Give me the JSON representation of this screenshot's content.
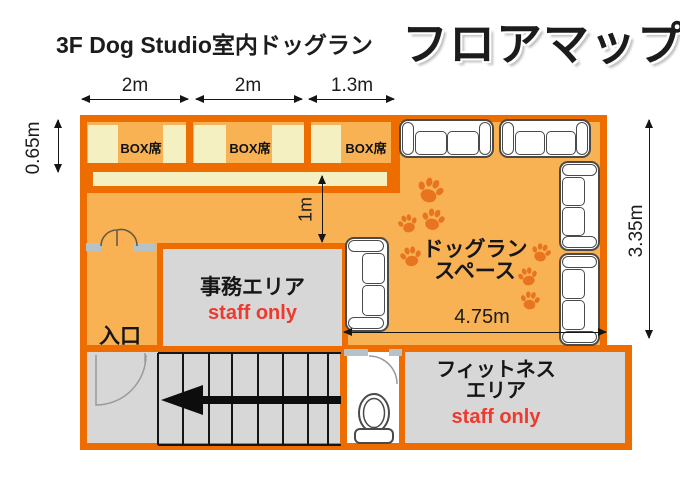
{
  "title": {
    "studio": "3F Dog Studio室内ドッグラン",
    "map": "フロアマップ"
  },
  "dimensions": {
    "top": [
      "2m",
      "2m",
      "1.3m"
    ],
    "left": "0.65m",
    "inner_vertical": "1m",
    "right": "3.35m",
    "inner_horizontal": "4.75m"
  },
  "box_seats": [
    "BOX席",
    "BOX席",
    "BOX席"
  ],
  "rooms": {
    "entrance": {
      "label": "入口"
    },
    "office": {
      "label": "事務エリア",
      "note": "staff only"
    },
    "dog_run": {
      "line1": "ドッグラン",
      "line2": "スペース"
    },
    "fitness": {
      "line1": "フィットネス",
      "line2": "エリア",
      "note": "staff only"
    }
  },
  "icons": {
    "paw": "paw-print",
    "toilet": "toilet-top-view",
    "stairs_arrow": "left-arrow",
    "doors": "door-swing"
  },
  "palette": {
    "wall_orange": "#ed6d00",
    "floor_orange": "#f8b254",
    "seat_cream": "#f5f0c2",
    "room_gray": "#d7d7d7",
    "wall_gray": "#b5c3c9",
    "staff_red": "#ee3a2e",
    "paw_orange": "#e87420",
    "line_black": "#1c1c1c"
  }
}
